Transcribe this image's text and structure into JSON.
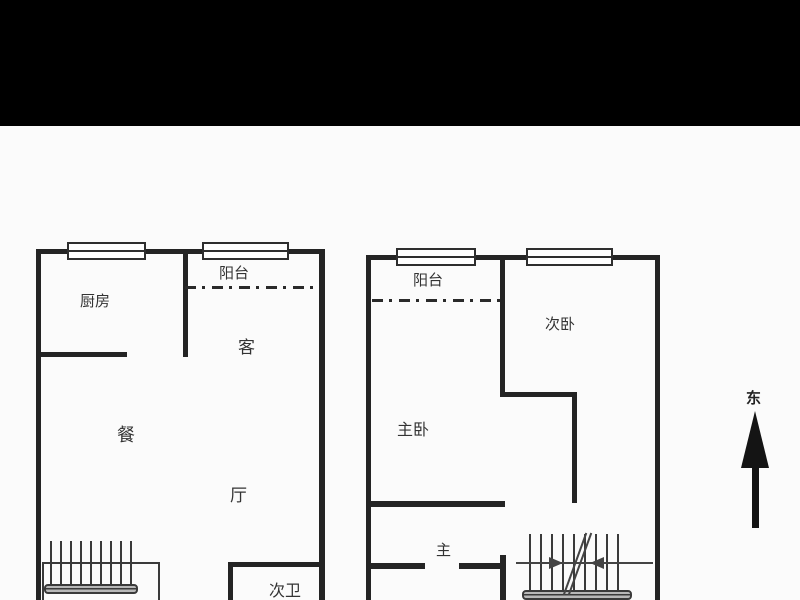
{
  "window": {
    "topbar_color": "#000000",
    "background": "#fbfbfb"
  },
  "plan": {
    "left_unit": {
      "labels": {
        "kitchen": "厨房",
        "balcony": "阳台",
        "living": "客",
        "dining": "餐",
        "hall": "厅",
        "second_bathroom": "次卫"
      }
    },
    "right_unit": {
      "labels": {
        "balcony": "阳台",
        "second_bedroom": "次卧",
        "master_bedroom": "主卧",
        "master": "主"
      }
    },
    "compass": {
      "east": "东"
    }
  },
  "colors": {
    "wall": "#242424",
    "thin_line": "#3a3a3a",
    "text": "#333333",
    "stair_bar": "#b8b8b8",
    "topbar": "#000000"
  }
}
